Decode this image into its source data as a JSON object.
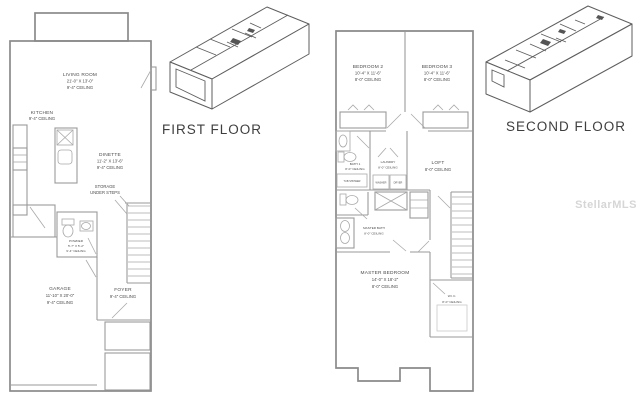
{
  "watermark": "StellarMLS",
  "first_floor": {
    "iso_label": "FIRST FLOOR",
    "living_room": {
      "name": "LIVING ROOM",
      "dims": "21'-0\" X 13'-0\"",
      "ceiling": "9'-4\" CEILING"
    },
    "kitchen": {
      "name": "KITCHEN",
      "ceiling": "9'-4\" CEILING"
    },
    "dinette": {
      "name": "DINETTE",
      "dims": "11'-2\" X 13'-6\"",
      "ceiling": "9'-4\" CEILING"
    },
    "storage": {
      "line1": "STORAGE",
      "line2": "UNDER STEPS"
    },
    "powder": {
      "name": "POWDER",
      "dims": "5'-7\" X 5'-2\"",
      "ceiling": "9'-4\" CEILING"
    },
    "garage": {
      "name": "GARAGE",
      "dims": "11'-10\" X 20'-0\"",
      "ceiling": "9'-4\" CEILING"
    },
    "foyer": {
      "name": "FOYER",
      "ceiling": "9'-4\" CEILING"
    }
  },
  "second_floor": {
    "iso_label": "SECOND FLOOR",
    "bedroom2": {
      "name": "BEDROOM 2",
      "dims": "10'-4\" X 11'-6\"",
      "ceiling": "8'-0\" CEILING"
    },
    "bedroom3": {
      "name": "BEDROOM 3",
      "dims": "10'-4\" X 11'-6\"",
      "ceiling": "8'-0\" CEILING"
    },
    "bath1": {
      "name": "BATH 1",
      "ceiling": "8'-0\" CEILING",
      "tub": "TUB SHOWER"
    },
    "laundry": {
      "name": "LAUNDRY",
      "ceiling": "8'-0\" CEILING",
      "washer": "WASHER",
      "dryer": "DRYER"
    },
    "loft": {
      "name": "LOFT",
      "ceiling": "8'-0\" CEILING"
    },
    "master_bath": {
      "name": "MASTER BATH",
      "ceiling": "8'-0\" CEILING"
    },
    "master_bedroom": {
      "name": "MASTER BEDROOM",
      "dims": "14'-0\" X 18'-2\"",
      "ceiling": "8'-0\" CEILING"
    },
    "wic": {
      "name": "W.I.C.",
      "ceiling": "8'-0\" CEILING"
    }
  }
}
